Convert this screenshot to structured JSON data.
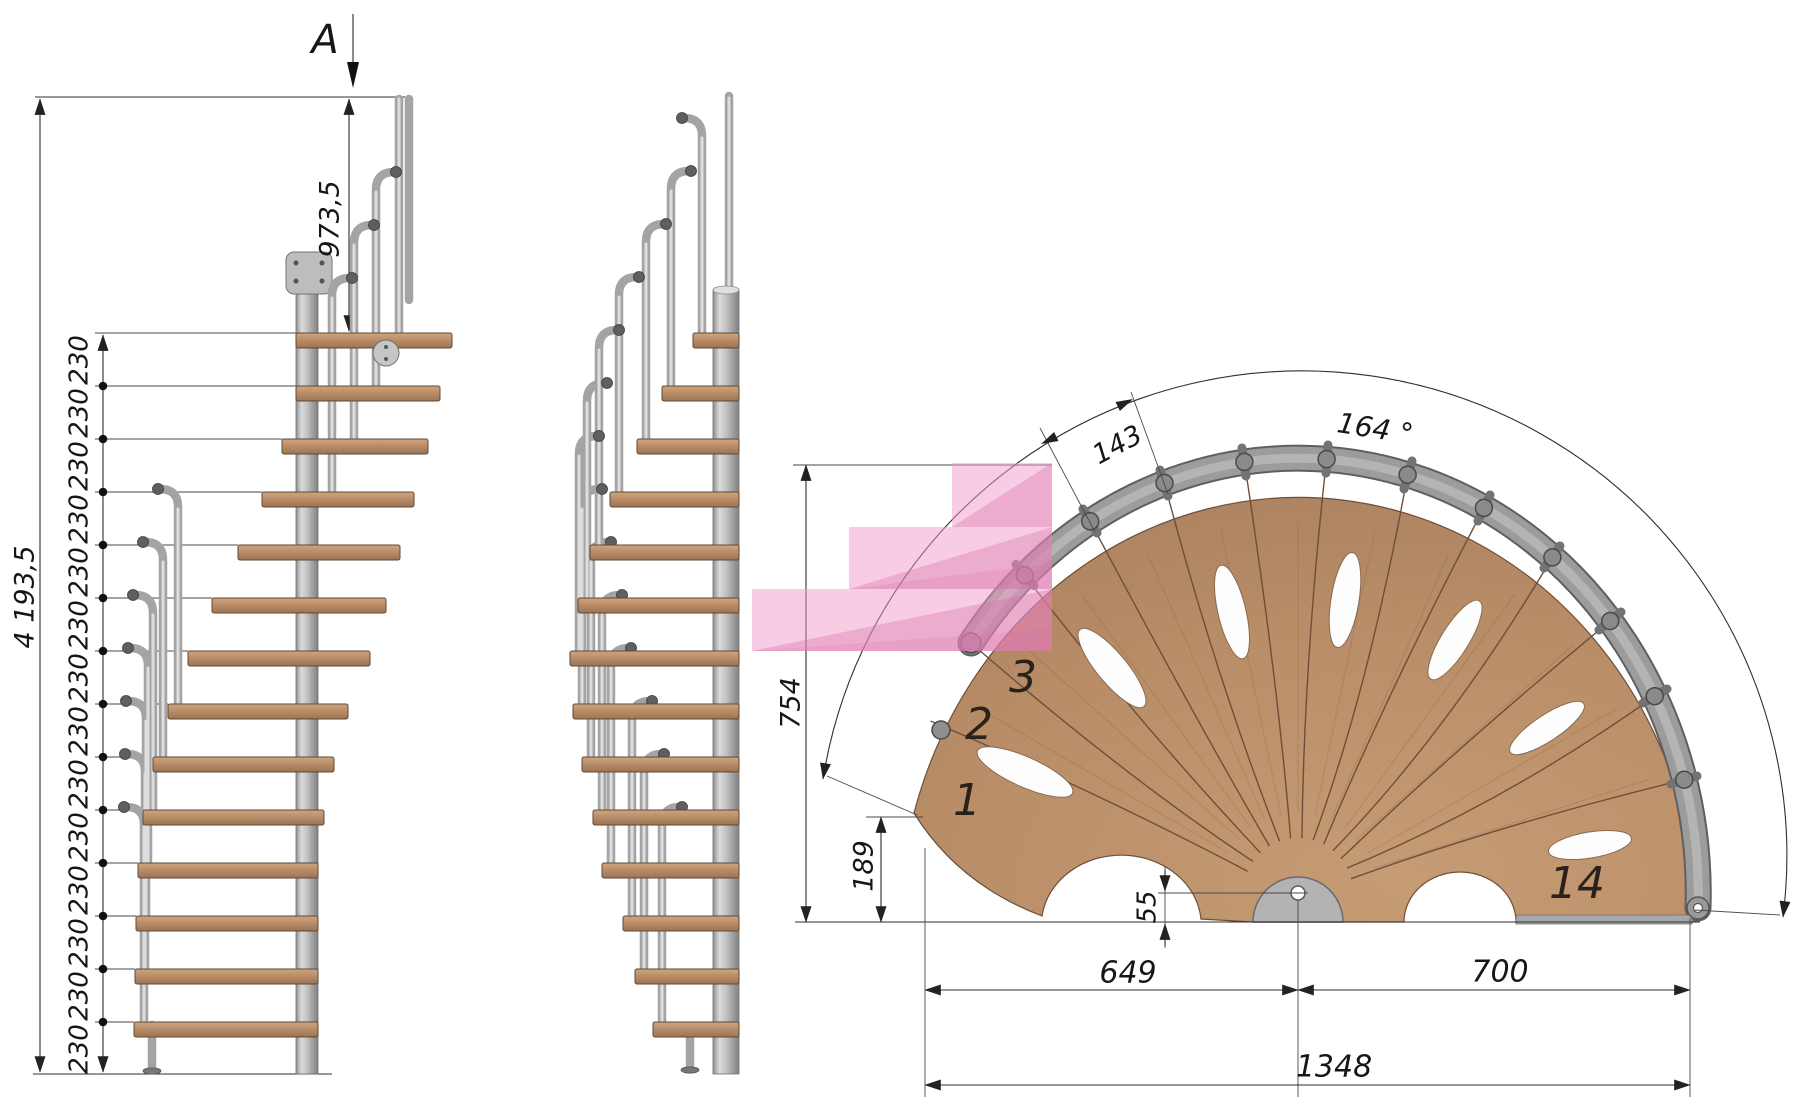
{
  "section_marker": {
    "label": "A"
  },
  "elevation": {
    "total_height": "4 193,5",
    "landing_height": "973,5",
    "riser_labels": [
      "230",
      "230",
      "230",
      "230",
      "230",
      "230",
      "230",
      "230",
      "230",
      "230",
      "230",
      "230",
      "230",
      "230"
    ]
  },
  "plan": {
    "tread_depth": "143",
    "rotation_angle": "164 °",
    "overall_depth": "754",
    "first_step_offset": "189",
    "pole_offset": "55",
    "left_span": "649",
    "right_span": "700",
    "total_span": "1348",
    "highlight_color": "#f29ac9",
    "step_numbers": {
      "first": "1",
      "second": "2",
      "third": "3",
      "last": "14"
    }
  }
}
